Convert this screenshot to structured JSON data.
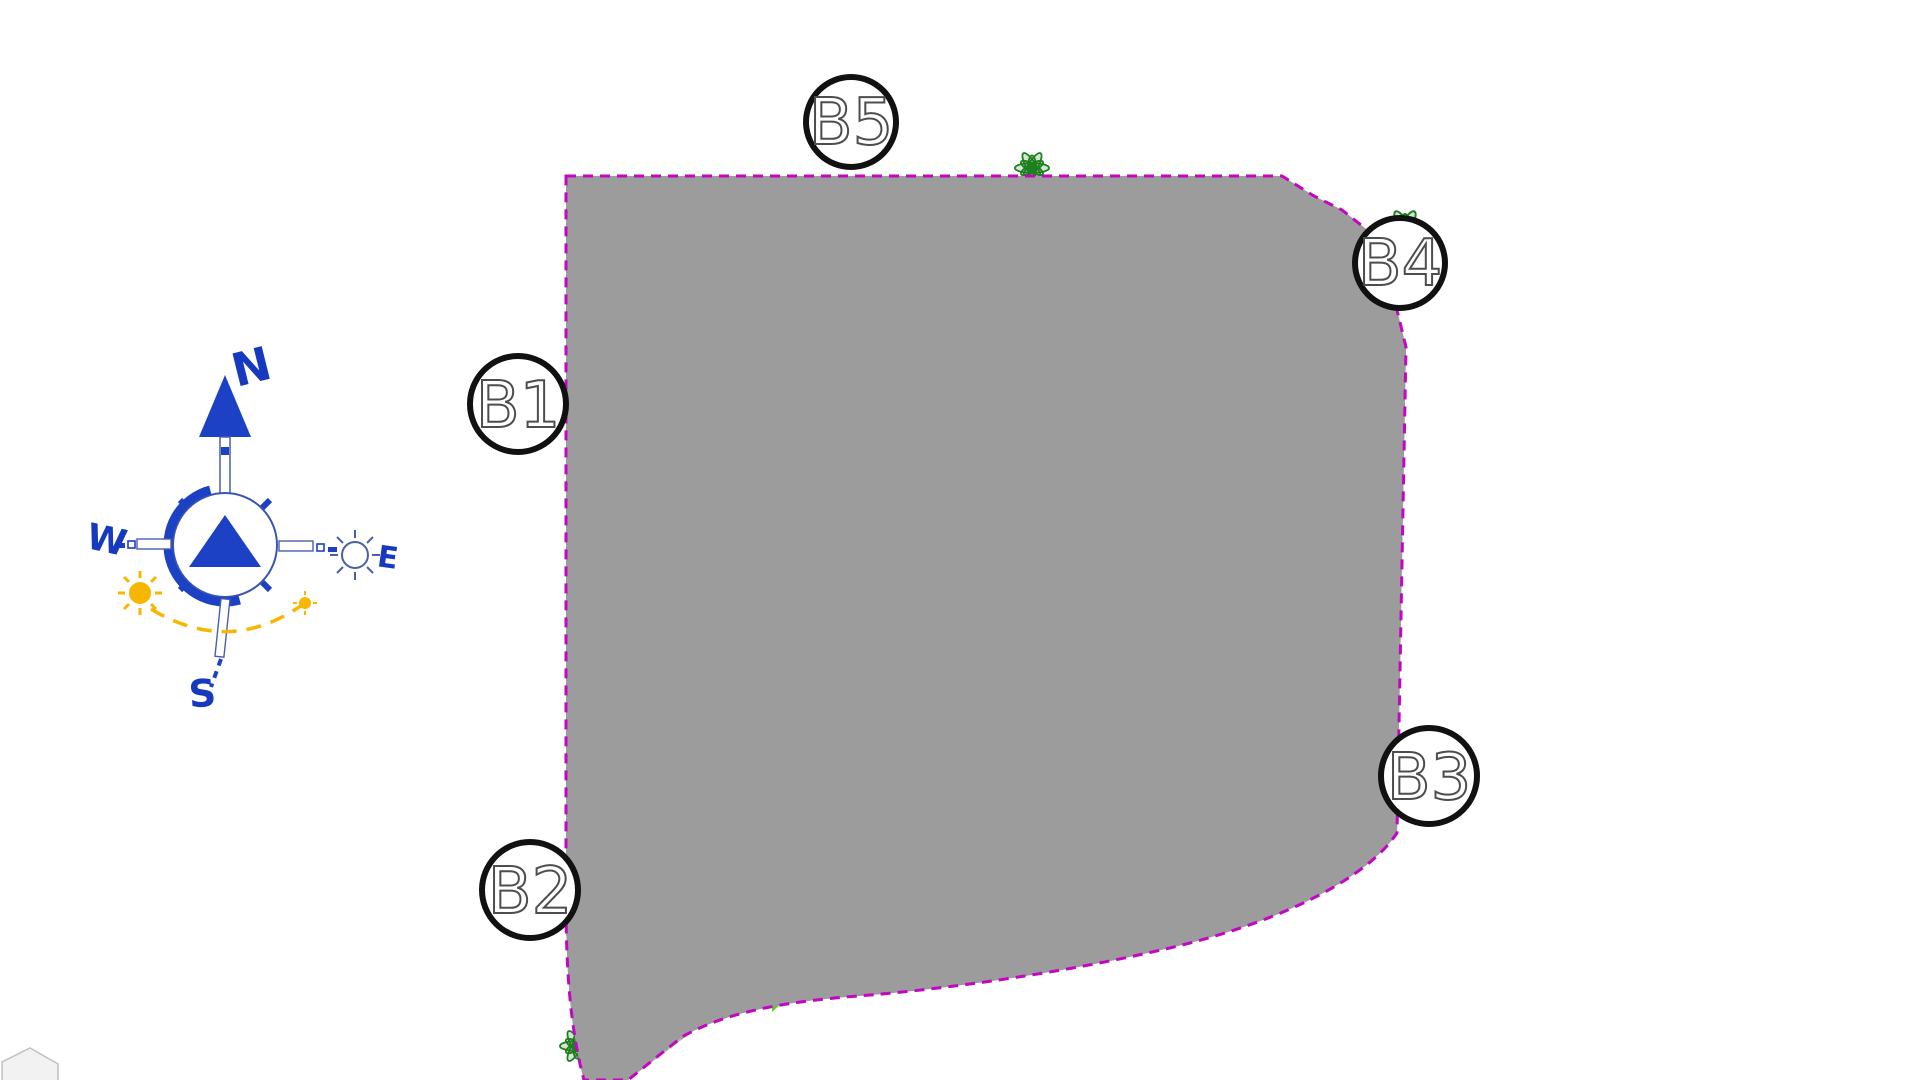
{
  "compass": {
    "north": "N",
    "south": "S",
    "east": "E",
    "west": "W"
  },
  "blocks": [
    {
      "id": "B1",
      "label": "B1",
      "units_rows": [
        [
          "01",
          "02",
          "03"
        ],
        [
          "04",
          "05",
          "06"
        ],
        [
          "07",
          "08",
          "09"
        ],
        [
          "10",
          "11",
          "12"
        ]
      ]
    },
    {
      "id": "B2",
      "label": "B2",
      "units_rows": [
        [
          "13",
          "14",
          "15"
        ],
        [
          "16",
          "17",
          "18"
        ],
        [
          "19",
          "20",
          "21"
        ],
        [
          "22",
          "23",
          "24"
        ],
        [
          "25",
          "26",
          "27"
        ],
        [
          "28",
          "29",
          "30"
        ]
      ]
    },
    {
      "id": "B3",
      "label": "B3",
      "units_rows": [
        [
          "48",
          "47",
          "46"
        ],
        [
          "45",
          "44",
          "43"
        ],
        [
          "42",
          "41",
          "40"
        ],
        [
          "39",
          "38",
          "37"
        ],
        [
          "36",
          "35",
          "34"
        ],
        [
          "33",
          "32",
          "31"
        ]
      ]
    },
    {
      "id": "B4",
      "label": "B4",
      "units_rows": [
        [
          "60",
          "59",
          "58"
        ],
        [
          "57",
          "56",
          "55"
        ],
        [
          "54",
          "53",
          "52"
        ],
        [
          "51",
          "50",
          "49"
        ]
      ]
    },
    {
      "id": "B5",
      "label": "B5",
      "units_rows": [
        [
          "76",
          "77",
          "78"
        ],
        [
          "73",
          "74",
          "75"
        ],
        [
          "70",
          "71",
          "72"
        ],
        [
          "67",
          "68",
          "69"
        ],
        [
          "64",
          "65",
          "66"
        ],
        [
          "61",
          "62",
          "63"
        ]
      ]
    }
  ],
  "amenities": {
    "petanca": "PETANCA",
    "children": "CHILDREN",
    "gym": "GIMNASIA",
    "minigolf": "MINIGOLF",
    "pingpong": "PING-PONG"
  },
  "colors": {
    "boundary": "#C206C2",
    "road": "#9C9C9C",
    "lawn_bright": "#2BD96B",
    "lawn_park": "#57CD1E",
    "building": "#FFFFFF",
    "unit_number": "#5355C6",
    "pool_water": "#8C93DC",
    "pool_deck": "#F3C453",
    "tree": "#1E7F1E",
    "compass_blue": "#1C41C4",
    "sun_yellow": "#F7B600"
  }
}
